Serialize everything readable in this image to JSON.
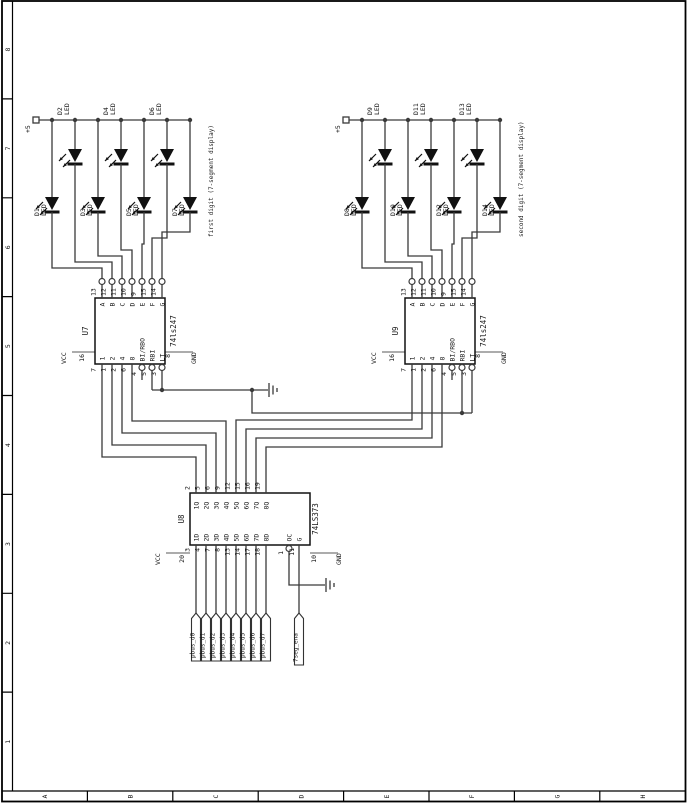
{
  "frame": {
    "rows": [
      "8",
      "7",
      "6",
      "5",
      "4",
      "3",
      "2",
      "1"
    ],
    "cols": [
      "A",
      "B",
      "C",
      "D",
      "E",
      "F",
      "G",
      "H"
    ]
  },
  "power": {
    "plus5": "+5"
  },
  "notes": {
    "first": "first digit (7-segment display)",
    "second": "second digit (7-segment display)"
  },
  "leds": {
    "g1_top": [
      {
        "ref": "D2",
        "part": "LED"
      },
      {
        "ref": "D4",
        "part": "LED"
      },
      {
        "ref": "D6",
        "part": "LED"
      }
    ],
    "g1_bottom": [
      {
        "ref": "D1",
        "part": "LED"
      },
      {
        "ref": "D3",
        "part": "LED"
      },
      {
        "ref": "D5",
        "part": "LED"
      },
      {
        "ref": "D7",
        "part": "LED"
      }
    ],
    "g2_top": [
      {
        "ref": "D9",
        "part": "LED"
      },
      {
        "ref": "D11",
        "part": "LED"
      },
      {
        "ref": "D13",
        "part": "LED"
      }
    ],
    "g2_bottom": [
      {
        "ref": "D8",
        "part": "LED"
      },
      {
        "ref": "D10",
        "part": "LED"
      },
      {
        "ref": "D12",
        "part": "LED"
      },
      {
        "ref": "D14",
        "part": "LED"
      }
    ]
  },
  "u7": {
    "ref": "U7"
  },
  "u9": {
    "ref": "U9"
  },
  "u247": {
    "part": "74ls247",
    "top_pins": [
      {
        "num": "13",
        "label": "A"
      },
      {
        "num": "12",
        "label": "B"
      },
      {
        "num": "11",
        "label": "C"
      },
      {
        "num": "10",
        "label": "D"
      },
      {
        "num": "9",
        "label": "E"
      },
      {
        "num": "15",
        "label": "F"
      },
      {
        "num": "14",
        "label": "G"
      }
    ],
    "in_pins": [
      {
        "num": "7",
        "label": "1"
      },
      {
        "num": "1",
        "label": "2"
      },
      {
        "num": "2",
        "label": "4"
      },
      {
        "num": "6",
        "label": "8"
      }
    ],
    "ctl_pins": [
      {
        "num": "4",
        "label": "BI/RBO"
      },
      {
        "num": "5",
        "label": "RBI"
      },
      {
        "num": "3",
        "label": "LT"
      }
    ],
    "vcc": "VCC",
    "vcc_num": "16",
    "gnd": "GND",
    "gnd_num": "8"
  },
  "u373": {
    "ref": "U8",
    "part": "74LS373",
    "pins": [
      {
        "num_top": "2",
        "q": "1Q",
        "num_bot": "3",
        "d": "1D",
        "net": "pbus_d0"
      },
      {
        "num_top": "5",
        "q": "2Q",
        "num_bot": "4",
        "d": "2D",
        "net": "pbus_d1"
      },
      {
        "num_top": "6",
        "q": "3Q",
        "num_bot": "7",
        "d": "3D",
        "net": "pbus_d2"
      },
      {
        "num_top": "9",
        "q": "4Q",
        "num_bot": "8",
        "d": "4D",
        "net": "pbus_d3"
      },
      {
        "num_top": "12",
        "q": "5Q",
        "num_bot": "13",
        "d": "5D",
        "net": "pbus_d4"
      },
      {
        "num_top": "15",
        "q": "6Q",
        "num_bot": "14",
        "d": "6D",
        "net": "pbus_d5"
      },
      {
        "num_top": "16",
        "q": "7Q",
        "num_bot": "17",
        "d": "7D",
        "net": "pbus_d6"
      },
      {
        "num_top": "19",
        "q": "8Q",
        "num_bot": "18",
        "d": "8D",
        "net": "pbus_d7"
      }
    ],
    "oc": {
      "label": "OC",
      "num": "1"
    },
    "g": {
      "label": "G",
      "num": "11"
    },
    "vcc": "VCC",
    "vcc_num": "20",
    "gnd": "GND",
    "gnd_num": "10",
    "ena_net": "7seg_ena"
  }
}
